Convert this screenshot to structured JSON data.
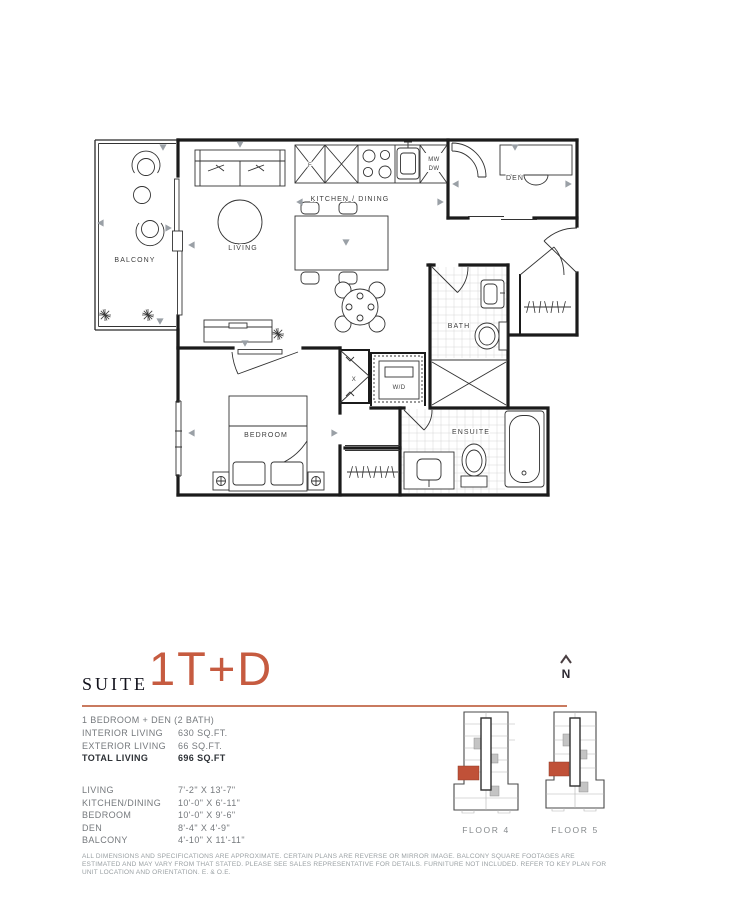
{
  "accent_color": "#c65b40",
  "title": {
    "prefix": "SUITE",
    "name": "1T+D"
  },
  "north": {
    "letter": "N"
  },
  "summary": {
    "type_line": "1 BEDROOM + DEN (2 BATH)",
    "rows": [
      {
        "label": "INTERIOR LIVING",
        "value": "630 SQ.FT."
      },
      {
        "label": "EXTERIOR LIVING",
        "value": "66 SQ.FT."
      },
      {
        "label": "TOTAL LIVING",
        "value": "696 SQ.FT"
      }
    ]
  },
  "dimensions": {
    "rows": [
      {
        "label": "LIVING",
        "value": "7'-2\" X 13'-7\""
      },
      {
        "label": "KITCHEN/DINING",
        "value": "10'-0\" X 6'-11\""
      },
      {
        "label": "BEDROOM",
        "value": "10'-0\" X 9'-6\""
      },
      {
        "label": "DEN",
        "value": "8'-4\" X 4'-9\""
      },
      {
        "label": "BALCONY",
        "value": "4'-10\" X 11'-11\""
      }
    ]
  },
  "floor_plan": {
    "labels": {
      "balcony": "BALCONY",
      "living": "LIVING",
      "kitchen_dining": "KITCHEN / DINING",
      "den": "DEN",
      "bath": "BATH",
      "wd": "W/D",
      "bedroom": "BEDROOM",
      "ensuite": "ENSUITE",
      "fridge": "F",
      "mw": "MW",
      "dw": "DW",
      "closet": "X"
    }
  },
  "key_plans": [
    {
      "label": "FLOOR 4"
    },
    {
      "label": "FLOOR 5"
    }
  ],
  "disclaimer": "ALL DIMENSIONS AND SPECIFICATIONS ARE APPROXIMATE. CERTAIN PLANS ARE REVERSE OR MIRROR IMAGE. BALCONY SQUARE FOOTAGES ARE ESTIMATED AND MAY VARY FROM THAT STATED. PLEASE SEE SALES REPRESENTATIVE FOR DETAILS. FURNITURE NOT INCLUDED. REFER TO KEY PLAN FOR UNIT LOCATION AND ORIENTATION. E. & O.E."
}
